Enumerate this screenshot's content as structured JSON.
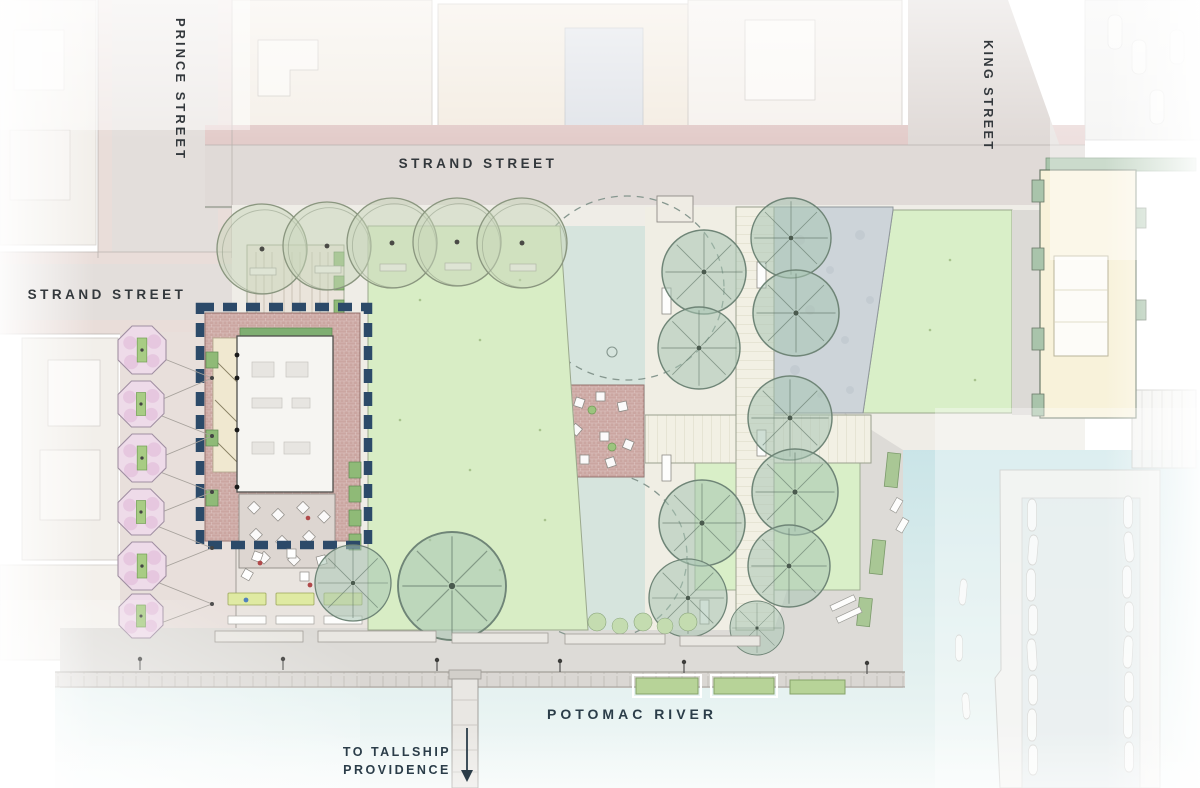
{
  "title": "Waterfront park landscape site plan",
  "labels": {
    "prince_street": "PRINCE STREET",
    "strand_street_top": "STRAND STREET",
    "strand_street_left": "STRAND STREET",
    "king_street": "KING STREET",
    "potomac_river": "POTOMAC RIVER",
    "tallship_line1": "TO TALLSHIP",
    "tallship_line2": "PROVIDENCE"
  },
  "colors": {
    "street_label": "#33383c",
    "water_label": "#2b3d49",
    "navy_dashed_outline": "#2c4a69",
    "lawn_green": "#d8edc5",
    "splash_pad": "#d6e4dd",
    "water": "#cde6e8",
    "street_gray": "#e0dad7",
    "sidewalk_pink": "#e3ccca",
    "brick_paving": "#cba6a1",
    "cream_building": "#f8f2da",
    "tree_green": "#a7c5b2",
    "cherry_pink": "#eedbe9"
  }
}
